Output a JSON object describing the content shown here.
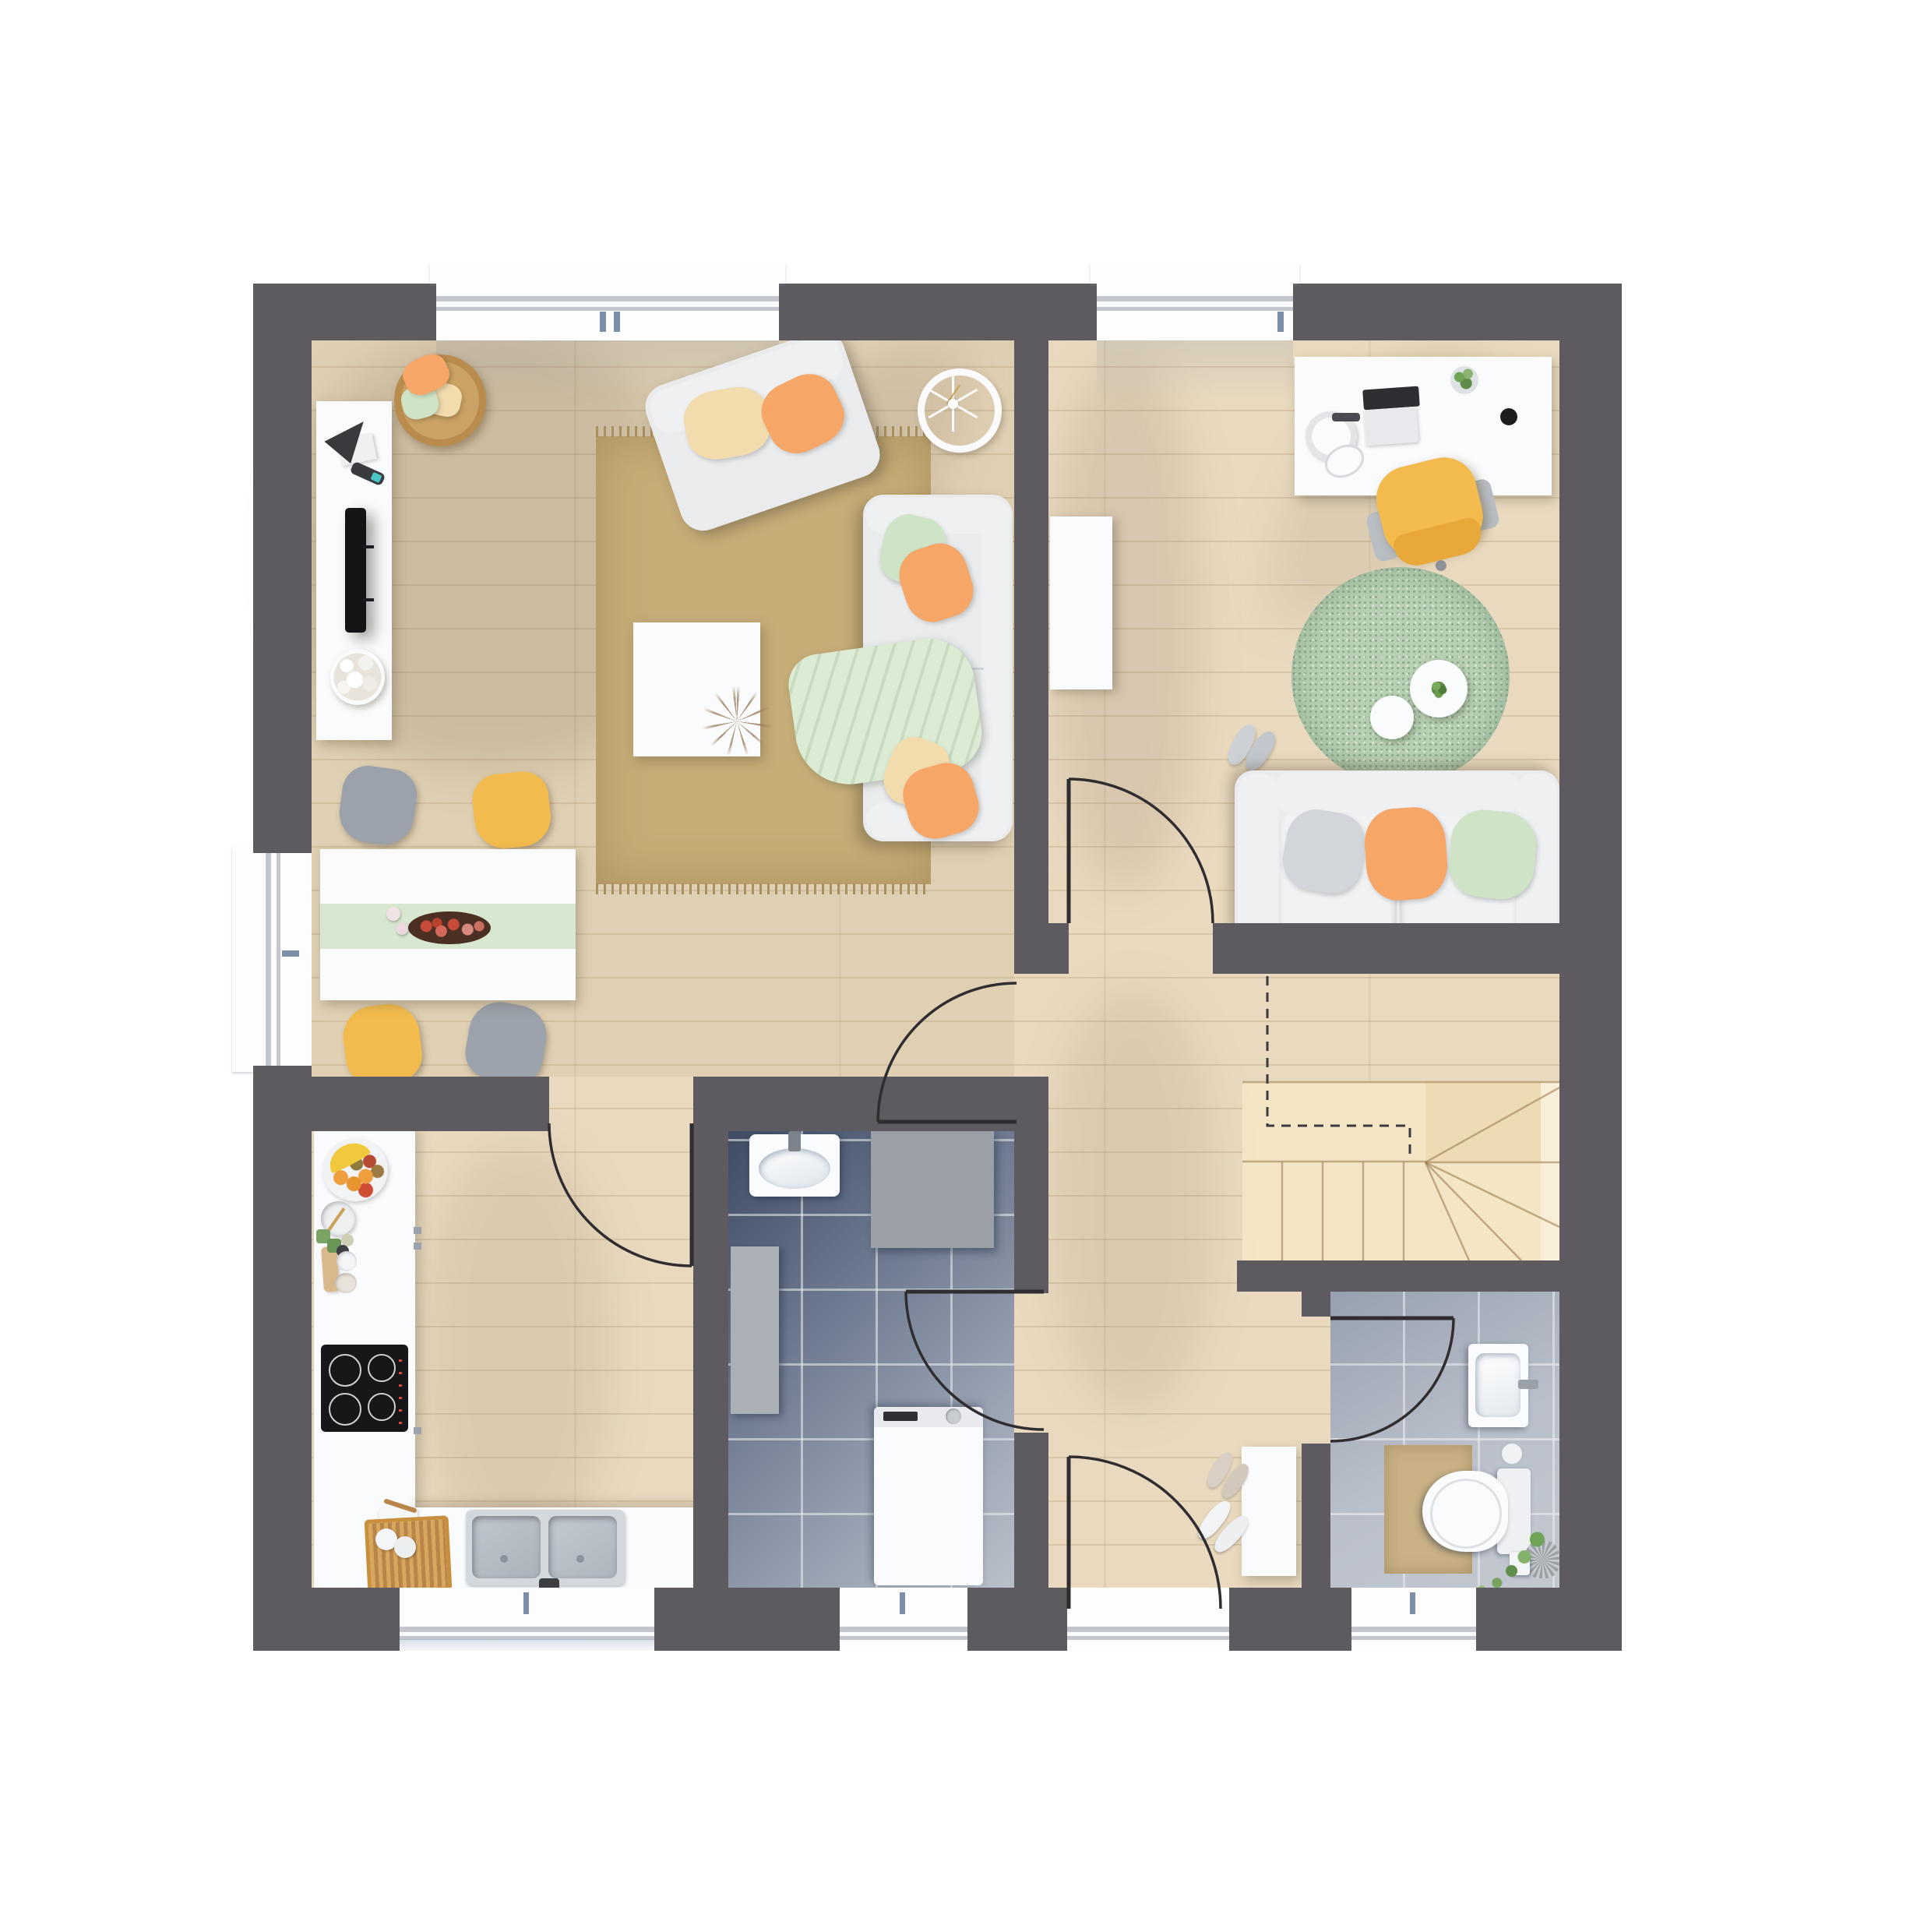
{
  "scene": {
    "type": "architectural-floor-plan",
    "view": "top-down-3d-render",
    "units": "none-visible",
    "text_on_image": "none"
  },
  "palette": {
    "canvasBg": "#ffffff",
    "wall": "#5e5b60",
    "wood": "#e9dabf",
    "woodEdge": "rgba(160,128,90,0.22)",
    "livingTint": "rgba(168,136,98,0.12)",
    "rugTan": "#c6ac77",
    "rugTanDark": "#a8905e",
    "rugGreen": "#b7cfb2",
    "stair": "#f4e5c5",
    "stairDark": "#eddbb4",
    "stairLight": "#f9efd8",
    "tileDarkA": "#3f4b63",
    "tileDarkB": "#6e7a90",
    "tileMid": "#97a0b0",
    "tileLight": "#bac0ca",
    "tileGrid": "rgba(238,238,242,0.55)",
    "winWhite": "#fdfdfe",
    "sillGray": "#c3c7cd",
    "glassBlue": "#7d8fa8",
    "panel": "#fafbfc",
    "softGray": "#eef0f2",
    "sofaBody": "#e9ebed",
    "sofaShade": "#ced3d8",
    "steel": "#c6ccd3",
    "steelDark": "#9aa1a9",
    "cooktop": "#17171a",
    "orange": "#f6a666",
    "cream": "#f2dcae",
    "mint": "#cfe3c6",
    "mintLight": "#dcebd4",
    "grayPillow": "#d2d5d9",
    "yellow": "#f3bb4d",
    "chairGray": "#9ba2ab",
    "woodAccent": "#c8903d",
    "mat": "#c9b185",
    "plantGreen": "#6fa356",
    "appleRed": "#c84b3a",
    "arcStroke": "#2f2d30",
    "stairLine": "rgba(150,118,74,0.55)",
    "dashLine": "#3c3a3e",
    "shadowWarm": "rgba(98,78,58,0.16)"
  },
  "rooms": [
    {
      "id": "living-dining-room",
      "floor": "wood",
      "furniture": [
        "tv-sideboard",
        "tv",
        "remote-control",
        "decor-sculpture",
        "pompom-flowers",
        "storage-basket-with-pillows",
        "area-rug",
        "loveseat",
        "coffee-table",
        "dried-plant-decor",
        "sofa",
        "throw-blanket",
        "wall-clock-decor",
        "dining-table",
        "table-runner",
        "apple-tray",
        "candles",
        "dining-chair-gray",
        "dining-chair-yellow",
        "dining-chair-yellow-2",
        "dining-chair-gray-2"
      ]
    },
    {
      "id": "home-office",
      "floor": "wood",
      "furniture": [
        "desk",
        "laptop",
        "headphones",
        "computer-mouse",
        "usb-stick",
        "desk-plant",
        "coaster",
        "office-chair",
        "round-rug",
        "nesting-side-table-large",
        "nesting-side-table-small",
        "table-plant",
        "slip-on-shoes",
        "two-seat-sofa",
        "wardrobe-cabinet"
      ]
    },
    {
      "id": "kitchen",
      "floor": "wood",
      "furniture": [
        "l-shaped-counter",
        "fruit-plate",
        "mixing-bowl",
        "spice-jars",
        "cutting-board",
        "prep-bowls",
        "induction-cooktop",
        "dish-rack",
        "kitchen-towel",
        "double-sink",
        "sink-faucet",
        "drawer-handles"
      ]
    },
    {
      "id": "bathroom",
      "floor": "tile",
      "furniture": [
        "wash-basin",
        "shower-tray",
        "tall-cabinet",
        "washing-machine"
      ]
    },
    {
      "id": "wc",
      "floor": "tile",
      "furniture": [
        "wash-basin",
        "toilet",
        "bath-mat",
        "toilet-paper-holder",
        "spare-paper-roll",
        "potted-plant"
      ]
    },
    {
      "id": "hallway",
      "floor": "wood",
      "furniture": [
        "shoe-cabinet",
        "slippers",
        "sneakers"
      ]
    },
    {
      "id": "staircase",
      "floor": "wood-steps",
      "furniture": [
        "winder-stairs",
        "headroom-dashed-line"
      ]
    }
  ],
  "openings": {
    "windows": 5,
    "exterior_doors": 2,
    "interior_door_arcs": 5
  }
}
